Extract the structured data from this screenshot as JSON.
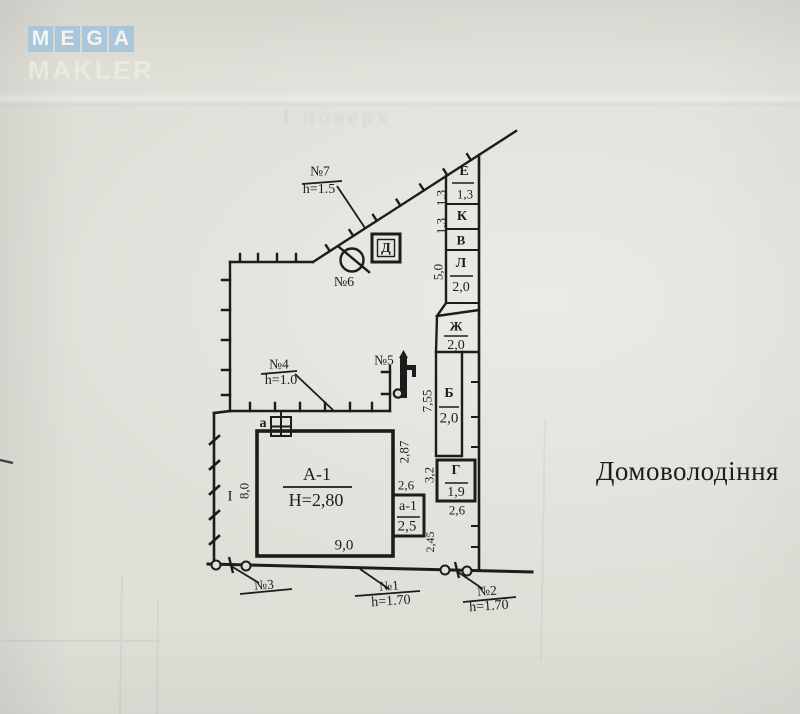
{
  "logo": {
    "letters": [
      "M",
      "E",
      "G",
      "A"
    ],
    "subtitle": "MAKLER"
  },
  "ghost_floor_text": "І поверх",
  "property_title": "Домоволодіння",
  "plan": {
    "structures": {
      "d_shed": "Д",
      "e": {
        "name": "Е",
        "dim": "1,3"
      },
      "k": {
        "name": "К"
      },
      "v": {
        "name": "В"
      },
      "l": {
        "name": "Л",
        "dim": "2,0"
      },
      "zh": {
        "name": "Ж",
        "dim": "2,0"
      },
      "b": {
        "name": "Б",
        "dim": "2,0"
      },
      "g": {
        "name": "Г",
        "dim": "1,9",
        "width": "2,6"
      },
      "main_house": {
        "name": "А-1",
        "height": "Н=2,80",
        "width": "9,0"
      },
      "annex": {
        "name": "а-1",
        "dim": "2,5",
        "width": "2,6"
      },
      "chimney": "а"
    },
    "marks": {
      "n1": {
        "label": "№1",
        "h": "h=1.70"
      },
      "n2": {
        "label": "№2",
        "h": "h=1.70"
      },
      "n3": {
        "label": "№3"
      },
      "n4": {
        "label": "№4",
        "h": "h=1.0"
      },
      "n5": {
        "label": "№5"
      },
      "n6": {
        "label": "№6"
      },
      "n7": {
        "label": "№7",
        "h": "h=1.5"
      }
    },
    "dimensions": {
      "e_k": "1,3",
      "k_v": "1,3",
      "l_len": "5,0",
      "b_len": "7,55",
      "house_right": "2,87",
      "g_side": "3,2",
      "annex_side": "2,45",
      "house_left": "8,0"
    },
    "section_label": "I"
  },
  "colors": {
    "paper": "#e0dfd8",
    "ink": "#1c1c1c",
    "logo_blue": "#a9c6da"
  }
}
